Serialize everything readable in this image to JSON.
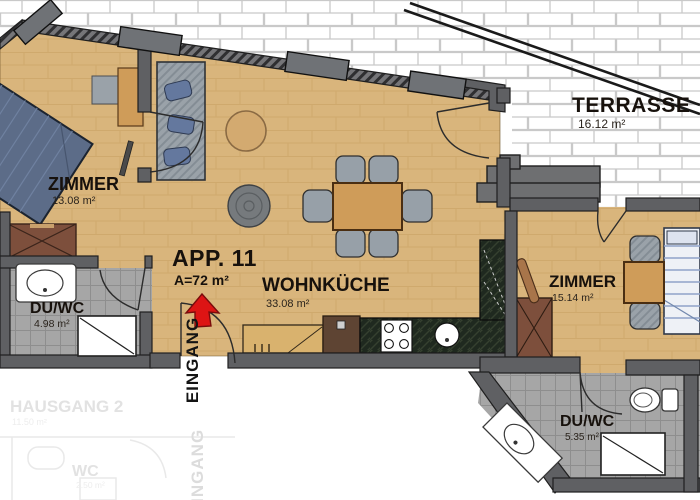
{
  "plan": {
    "app": {
      "label": "APP. 11",
      "area": "A=72 m²"
    },
    "rooms": [
      {
        "id": "zimmer-left",
        "name": "ZIMMER",
        "area": "13.08 m²"
      },
      {
        "id": "wohnkueche",
        "name": "WOHNKÜCHE",
        "area": "33.08 m²"
      },
      {
        "id": "zimmer-right",
        "name": "ZIMMER",
        "area": "15.14 m²"
      },
      {
        "id": "terrasse",
        "name": "TERRASSE",
        "area": "16.12 m²"
      },
      {
        "id": "duwc-left",
        "name": "DU/WC",
        "area": "4.98 m²"
      },
      {
        "id": "duwc-right",
        "name": "DU/WC",
        "area": "5.35 m²"
      },
      {
        "id": "hausgang",
        "name": "HAUSGANG 2",
        "area": "11.50 m²"
      },
      {
        "id": "wc",
        "name": "WC",
        "area": "2.50 m²"
      }
    ],
    "entrance": {
      "label": "EINGANG",
      "faded_label": "EINGANG"
    },
    "colors": {
      "wood_floor": "#d9b57c",
      "wall_gray": "#5f6063",
      "brick_line": "#c9c9c9",
      "bath_tile": "#a6a6a6",
      "kitchen_counter": "#1f291f",
      "furniture_brown": "#7d4f3c",
      "bed_blue": "#5c6c88",
      "entrance_arrow_red": "#dd1414"
    }
  }
}
